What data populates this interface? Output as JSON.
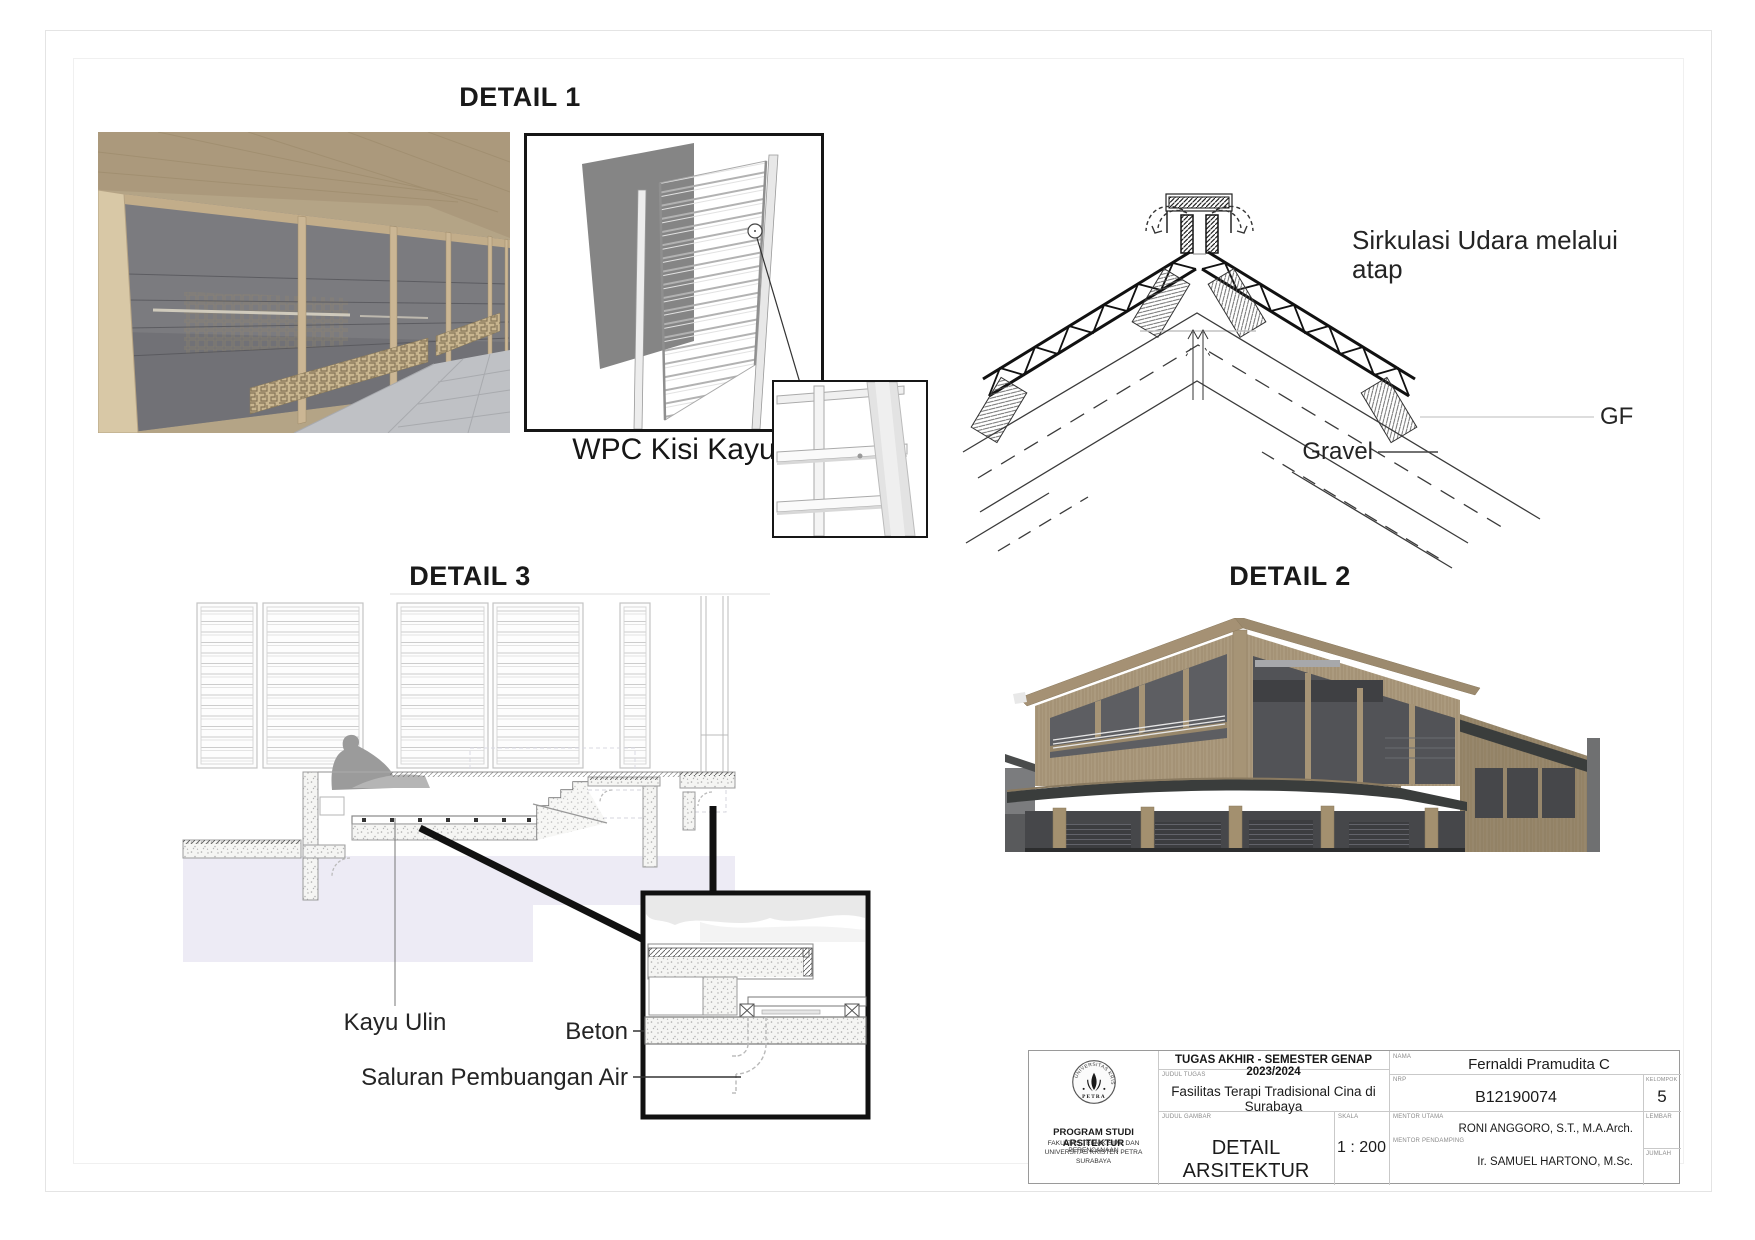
{
  "page": {
    "width": 1755,
    "height": 1240,
    "background": "#ffffff",
    "line_color": "#1a1a1a",
    "wash_color": "#edebf5"
  },
  "labels": {
    "detail1_title": "DETAIL 1",
    "detail1_caption": "WPC Kisi Kayu",
    "detail2_title": "DETAIL 2",
    "detail3_title": "DETAIL 3",
    "roof_air": "Sirkulasi Udara melalui atap",
    "roof_gf": "GF",
    "roof_gravel": "Gravel",
    "d3_kayu": "Kayu Ulin",
    "d3_beton": "Beton",
    "d3_saluran": "Saluran Pembuangan Air"
  },
  "title_block": {
    "header": "TUGAS AKHIR - SEMESTER GENAP 2023/2024",
    "labels": {
      "judul_tugas": "JUDUL TUGAS",
      "judul_gambar": "JUDUL GAMBAR",
      "skala": "SKALA",
      "nama": "NAMA",
      "nrp": "NRP",
      "kelompok": "KELOMPOK",
      "lembar": "LEMBAR",
      "jumlah": "JUMLAH",
      "mentor_utama": "MENTOR UTAMA",
      "mentor_pendamping": "MENTOR PENDAMPING"
    },
    "values": {
      "judul_tugas": "Fasilitas Terapi Tradisional Cina di Surabaya",
      "judul_gambar": "DETAIL ARSITEKTUR",
      "skala": "1 : 200",
      "nama": "Fernaldi Pramudita C",
      "nrp": "B12190074",
      "kelompok": "5",
      "lembar": "",
      "jumlah": "",
      "mentor_utama": "RONI ANGGORO, S.T., M.A.Arch.",
      "mentor_pendamping": "Ir. SAMUEL HARTONO, M.Sc."
    },
    "institution": {
      "line1": "PROGRAM STUDI ARSITEKTUR",
      "line2": "FAKULTAS TEKNIK SIPIL DAN PERENCANAAN",
      "line3": "UNIVERSITAS KRISTEN PETRA",
      "line4": "SURABAYA",
      "seal_top": "UNIVERSITAS KRISTEN",
      "seal_bottom": "PETRA"
    }
  }
}
